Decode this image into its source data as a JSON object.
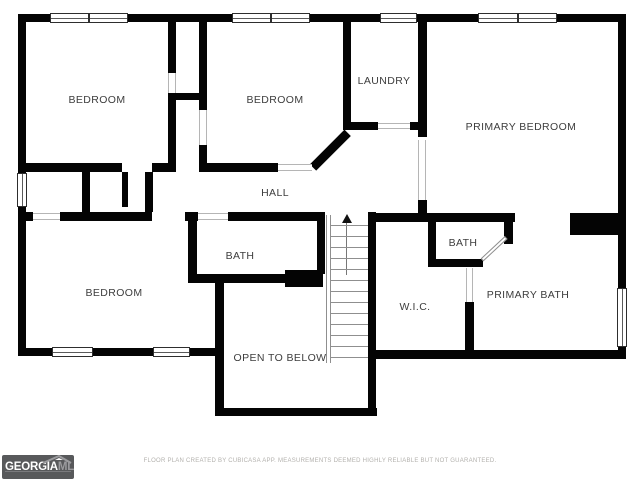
{
  "title": "Second floor plan",
  "rooms": [
    {
      "id": "bedroom-top-left",
      "label": "BEDROOM"
    },
    {
      "id": "bedroom-top-middle",
      "label": "BEDROOM"
    },
    {
      "id": "laundry",
      "label": "LAUNDRY"
    },
    {
      "id": "primary-bedroom",
      "label": "PRIMARY BEDROOM"
    },
    {
      "id": "hall",
      "label": "HALL"
    },
    {
      "id": "bedroom-bottom-left",
      "label": "BEDROOM"
    },
    {
      "id": "bath-middle",
      "label": "BATH"
    },
    {
      "id": "bath-right",
      "label": "BATH"
    },
    {
      "id": "wic",
      "label": "W.I.C."
    },
    {
      "id": "primary-bath",
      "label": "PRIMARY BATH"
    },
    {
      "id": "open-to-below",
      "label": "OPEN TO BELOW"
    }
  ],
  "footer": {
    "disclaimer": "FLOOR PLAN CREATED BY CUBICASA APP. MEASUREMENTS DEEMED HIGHLY RELIABLE BUT NOT GUARANTEED."
  },
  "logo": {
    "name_primary": "GEORGIA",
    "name_secondary": "MLS",
    "tagline": "REAL ESTATE SERVICES"
  },
  "colors": {
    "wall": "#040404",
    "label_text": "#3d3d3d",
    "opening_line": "#b5b5b5",
    "window_frame": "#2e2e2e",
    "footer_text": "#b3b1ad",
    "logo_background": "#58595b"
  },
  "plan_geometry": {
    "walls": [
      {
        "x": 18,
        "y": 14,
        "w": 608,
        "h": 8
      },
      {
        "x": 18,
        "y": 14,
        "w": 8,
        "h": 342
      },
      {
        "x": 618,
        "y": 14,
        "w": 8,
        "h": 345
      },
      {
        "x": 18,
        "y": 348,
        "w": 206,
        "h": 8
      },
      {
        "x": 215,
        "y": 283,
        "w": 9,
        "h": 133
      },
      {
        "x": 215,
        "y": 408,
        "w": 162,
        "h": 8
      },
      {
        "x": 368,
        "y": 212,
        "w": 8,
        "h": 204
      },
      {
        "x": 368,
        "y": 350,
        "w": 258,
        "h": 9
      },
      {
        "x": 168,
        "y": 22,
        "w": 8,
        "h": 51
      },
      {
        "x": 168,
        "y": 93,
        "w": 8,
        "h": 79
      },
      {
        "x": 199,
        "y": 22,
        "w": 8,
        "h": 88
      },
      {
        "x": 199,
        "y": 145,
        "w": 8,
        "h": 27
      },
      {
        "x": 172,
        "y": 93,
        "w": 33,
        "h": 7
      },
      {
        "x": 343,
        "y": 14,
        "w": 8,
        "h": 114
      },
      {
        "x": 418,
        "y": 14,
        "w": 9,
        "h": 123
      },
      {
        "x": 418,
        "y": 200,
        "w": 9,
        "h": 13
      },
      {
        "x": 343,
        "y": 122,
        "w": 35,
        "h": 8
      },
      {
        "x": 410,
        "y": 122,
        "w": 17,
        "h": 8
      },
      {
        "x": 199,
        "y": 163,
        "w": 79,
        "h": 9
      },
      {
        "x": 26,
        "y": 163,
        "w": 96,
        "h": 9
      },
      {
        "x": 152,
        "y": 163,
        "w": 21,
        "h": 9
      },
      {
        "x": 82,
        "y": 172,
        "w": 8,
        "h": 40
      },
      {
        "x": 122,
        "y": 172,
        "w": 6,
        "h": 35
      },
      {
        "x": 145,
        "y": 172,
        "w": 8,
        "h": 40
      },
      {
        "x": 18,
        "y": 212,
        "w": 15,
        "h": 9
      },
      {
        "x": 60,
        "y": 212,
        "w": 92,
        "h": 9
      },
      {
        "x": 185,
        "y": 212,
        "w": 13,
        "h": 9
      },
      {
        "x": 228,
        "y": 212,
        "w": 97,
        "h": 9
      },
      {
        "x": 368,
        "y": 213,
        "w": 147,
        "h": 9
      },
      {
        "x": 570,
        "y": 213,
        "w": 48,
        "h": 22
      },
      {
        "x": 188,
        "y": 212,
        "w": 9,
        "h": 71
      },
      {
        "x": 188,
        "y": 274,
        "w": 97,
        "h": 9
      },
      {
        "x": 285,
        "y": 270,
        "w": 38,
        "h": 17
      },
      {
        "x": 317,
        "y": 212,
        "w": 8,
        "h": 62
      },
      {
        "x": 428,
        "y": 222,
        "w": 8,
        "h": 45
      },
      {
        "x": 428,
        "y": 259,
        "w": 55,
        "h": 8
      },
      {
        "x": 504,
        "y": 213,
        "w": 9,
        "h": 31
      },
      {
        "x": 465,
        "y": 302,
        "w": 9,
        "h": 50
      }
    ],
    "diagonal_walls": [
      {
        "x": 313,
        "y": 163,
        "w": 49,
        "h": 9,
        "angle": -45
      }
    ],
    "door_leaves": [
      {
        "x": 482,
        "y": 258,
        "w": 33,
        "h": 4,
        "angle": -43
      }
    ],
    "openings": [
      {
        "x": 33,
        "y": 213,
        "w": 27,
        "h": 7,
        "dir": "h"
      },
      {
        "x": 198,
        "y": 213,
        "w": 30,
        "h": 7,
        "dir": "h"
      },
      {
        "x": 278,
        "y": 164,
        "w": 34,
        "h": 7,
        "dir": "h"
      },
      {
        "x": 378,
        "y": 123,
        "w": 32,
        "h": 6,
        "dir": "h"
      },
      {
        "x": 418,
        "y": 140,
        "w": 8,
        "h": 60,
        "dir": "v"
      },
      {
        "x": 466,
        "y": 268,
        "w": 7,
        "h": 34,
        "dir": "v"
      },
      {
        "x": 168,
        "y": 73,
        "w": 8,
        "h": 20,
        "dir": "v"
      },
      {
        "x": 199,
        "y": 110,
        "w": 8,
        "h": 35,
        "dir": "v"
      }
    ],
    "windows": [
      {
        "x": 50,
        "y": 13,
        "w": 78,
        "h": 10,
        "dir": "h",
        "double": true
      },
      {
        "x": 232,
        "y": 13,
        "w": 78,
        "h": 10,
        "dir": "h",
        "double": true
      },
      {
        "x": 380,
        "y": 13,
        "w": 37,
        "h": 10,
        "dir": "h",
        "double": false
      },
      {
        "x": 478,
        "y": 13,
        "w": 79,
        "h": 10,
        "dir": "h",
        "double": true
      },
      {
        "x": 17,
        "y": 173,
        "w": 10,
        "h": 34,
        "dir": "v",
        "double": false
      },
      {
        "x": 52,
        "y": 347,
        "w": 41,
        "h": 10,
        "dir": "h",
        "double": false
      },
      {
        "x": 153,
        "y": 347,
        "w": 37,
        "h": 10,
        "dir": "h",
        "double": false
      },
      {
        "x": 617,
        "y": 288,
        "w": 10,
        "h": 59,
        "dir": "v",
        "double": false
      }
    ],
    "stairs": {
      "treads": {
        "x": 331,
        "w": 37,
        "y0": 225,
        "step": 11,
        "count": 13
      },
      "rail": {
        "x": 326,
        "y": 215,
        "w": 5,
        "h": 148
      }
    }
  }
}
